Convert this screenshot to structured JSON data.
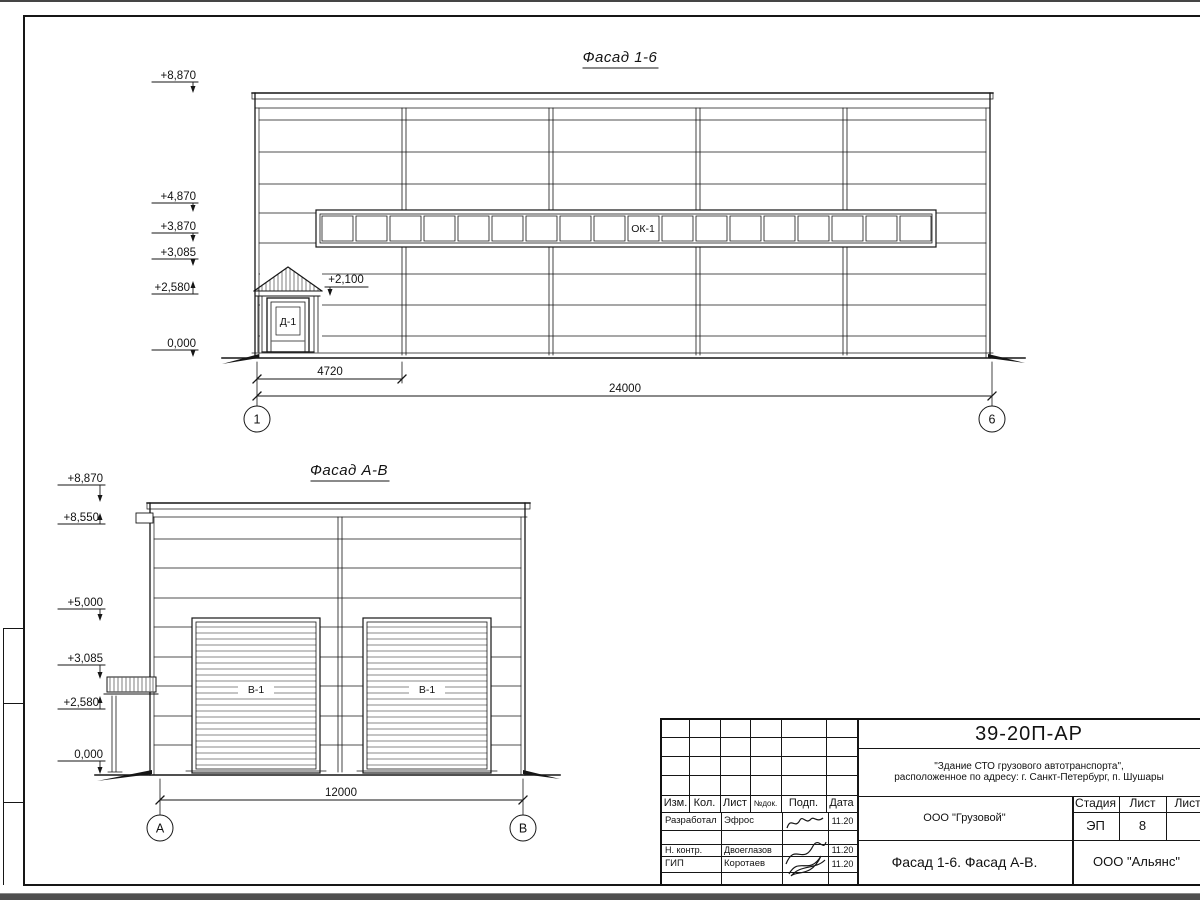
{
  "colors": {
    "ink": "#161616",
    "paper": "#ffffff"
  },
  "facade16": {
    "title": "Фасад 1-6",
    "marks": {
      "m8870": "+8,870",
      "m4870": "+4,870",
      "m3870": "+3,870",
      "m3085": "+3,085",
      "m2580": "+2,580",
      "m0": "0,000",
      "m2100": "+2,100"
    },
    "window_label": "ОК-1",
    "door_label": "Д-1",
    "dim_door": "4720",
    "dim_total": "24000",
    "axis_left": "1",
    "axis_right": "6"
  },
  "facadeAB": {
    "title": "Фасад А-В",
    "marks": {
      "m8870": "+8,870",
      "m8550": "+8,550",
      "m5000": "+5,000",
      "m3085": "+3,085",
      "m2580": "+2,580",
      "m0": "0,000"
    },
    "gate_label": "В-1",
    "dim_total": "12000",
    "axis_left": "А",
    "axis_right": "В"
  },
  "titleblock": {
    "doc_number": "39-20П-АР",
    "project_line1": "\"Здание СТО грузового автотранспорта\",",
    "project_line2": "расположенное по адресу: г. Санкт-Петербург, п. Шушары",
    "company": "ООО \"Грузовой\"",
    "sheet_title": "Фасад 1-6. Фасад А-В.",
    "contractor": "ООО \"Альянс\"",
    "stage_label": "Стадия",
    "sheet_label": "Лист",
    "sheets_label": "Листов",
    "stage_value": "ЭП",
    "sheet_value": "8",
    "header": {
      "izm": "Изм.",
      "kol": "Кол.",
      "list": "Лист",
      "ndok": "№док.",
      "podp": "Подп.",
      "data": "Дата"
    },
    "rows": [
      {
        "role": "Разработал",
        "name": "Эфрос",
        "date": "11.20"
      },
      {
        "role": "Н. контр.",
        "name": "Двоеглазов",
        "date": "11.20"
      },
      {
        "role": "ГИП",
        "name": "Коротаев",
        "date": "11.20"
      }
    ]
  }
}
